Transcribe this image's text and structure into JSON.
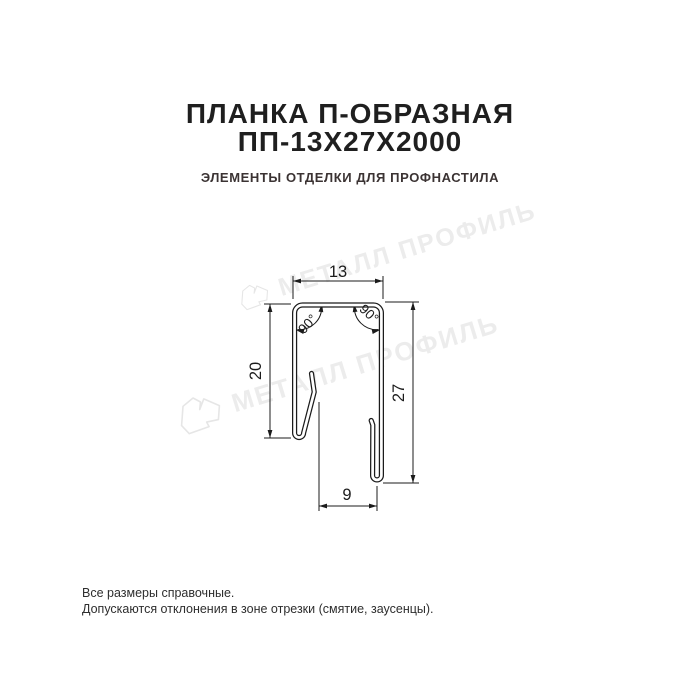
{
  "title": {
    "line1": "ПЛАНКА П-ОБРАЗНАЯ",
    "line2": "ПП-13Х27Х2000",
    "subtitle": "ЭЛЕМЕНТЫ ОТДЕЛКИ ДЛЯ ПРОФНАСТИЛА"
  },
  "drawing": {
    "type": "technical-profile-cross-section",
    "dimensions": {
      "top_width": "13",
      "left_height": "20",
      "right_height": "27",
      "bottom_width": "9",
      "angle_left": "90°",
      "angle_right": "90°"
    }
  },
  "watermark": {
    "text": "МЕТАЛЛ ПРОФИЛЬ"
  },
  "footer": {
    "line1": "Все размеры справочные.",
    "line2": "Допускаются отклонения в зоне отрезки (смятие, заусенцы)."
  },
  "colors": {
    "title": "#1f1f1f",
    "subtitle": "#3b3333",
    "drawing_line": "#1b1b1b",
    "watermark": "#ececec",
    "background": "#ffffff"
  }
}
